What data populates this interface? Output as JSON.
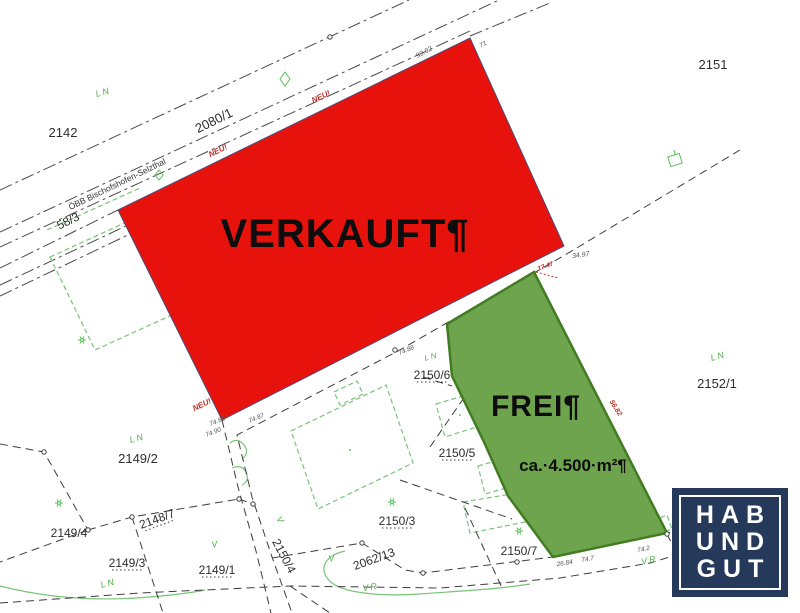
{
  "plan": {
    "sold_label": "VERKAUFT¶",
    "free_label": "FREI¶",
    "free_area": "ca.·4.500·m²¶",
    "railway_name": "ÖBB Bischofshofen-Selzthal",
    "neu_marker": "NEU!",
    "parcels": {
      "p2142": "2142",
      "p2151": "2151",
      "p2152_1": "2152/1",
      "p2150_6": "2150/6",
      "p2150_5": "2150/5",
      "p2150_3": "2150/3",
      "p2150_7": "2150/7",
      "p2150_4": "2150/4",
      "p2149_1": "2149/1",
      "p2149_2": "2149/2",
      "p2149_3": "2149/3",
      "p2149_4": "2149/4",
      "p2148_7": "2148/7",
      "p2062_13": "2062/13",
      "p2080_1": "2080/1",
      "p58_3": "58/3"
    },
    "landuse": {
      "ln": "LN",
      "v": "V",
      "vr": "VR"
    },
    "measurements": {
      "m9392": "93.92",
      "m71": "71",
      "m3497": "34.97",
      "m1747": "17.47",
      "m5682": "56.82",
      "m7485": "74.85",
      "m7487": "74.87",
      "m7490": "74.90",
      "m7488": "74.88",
      "m2684": "26.84",
      "m747": "74.7",
      "m742": "74.2"
    },
    "colors": {
      "sold_fill": "#e8120c",
      "free_fill": "#6fa44e",
      "free_border": "#417c22",
      "annotation_red": "#c03028",
      "map_green": "#54ae4c",
      "logo_navy": "#25395b"
    }
  },
  "logo": {
    "line1": "HAB",
    "line2": "UND",
    "line3": "GUT"
  }
}
